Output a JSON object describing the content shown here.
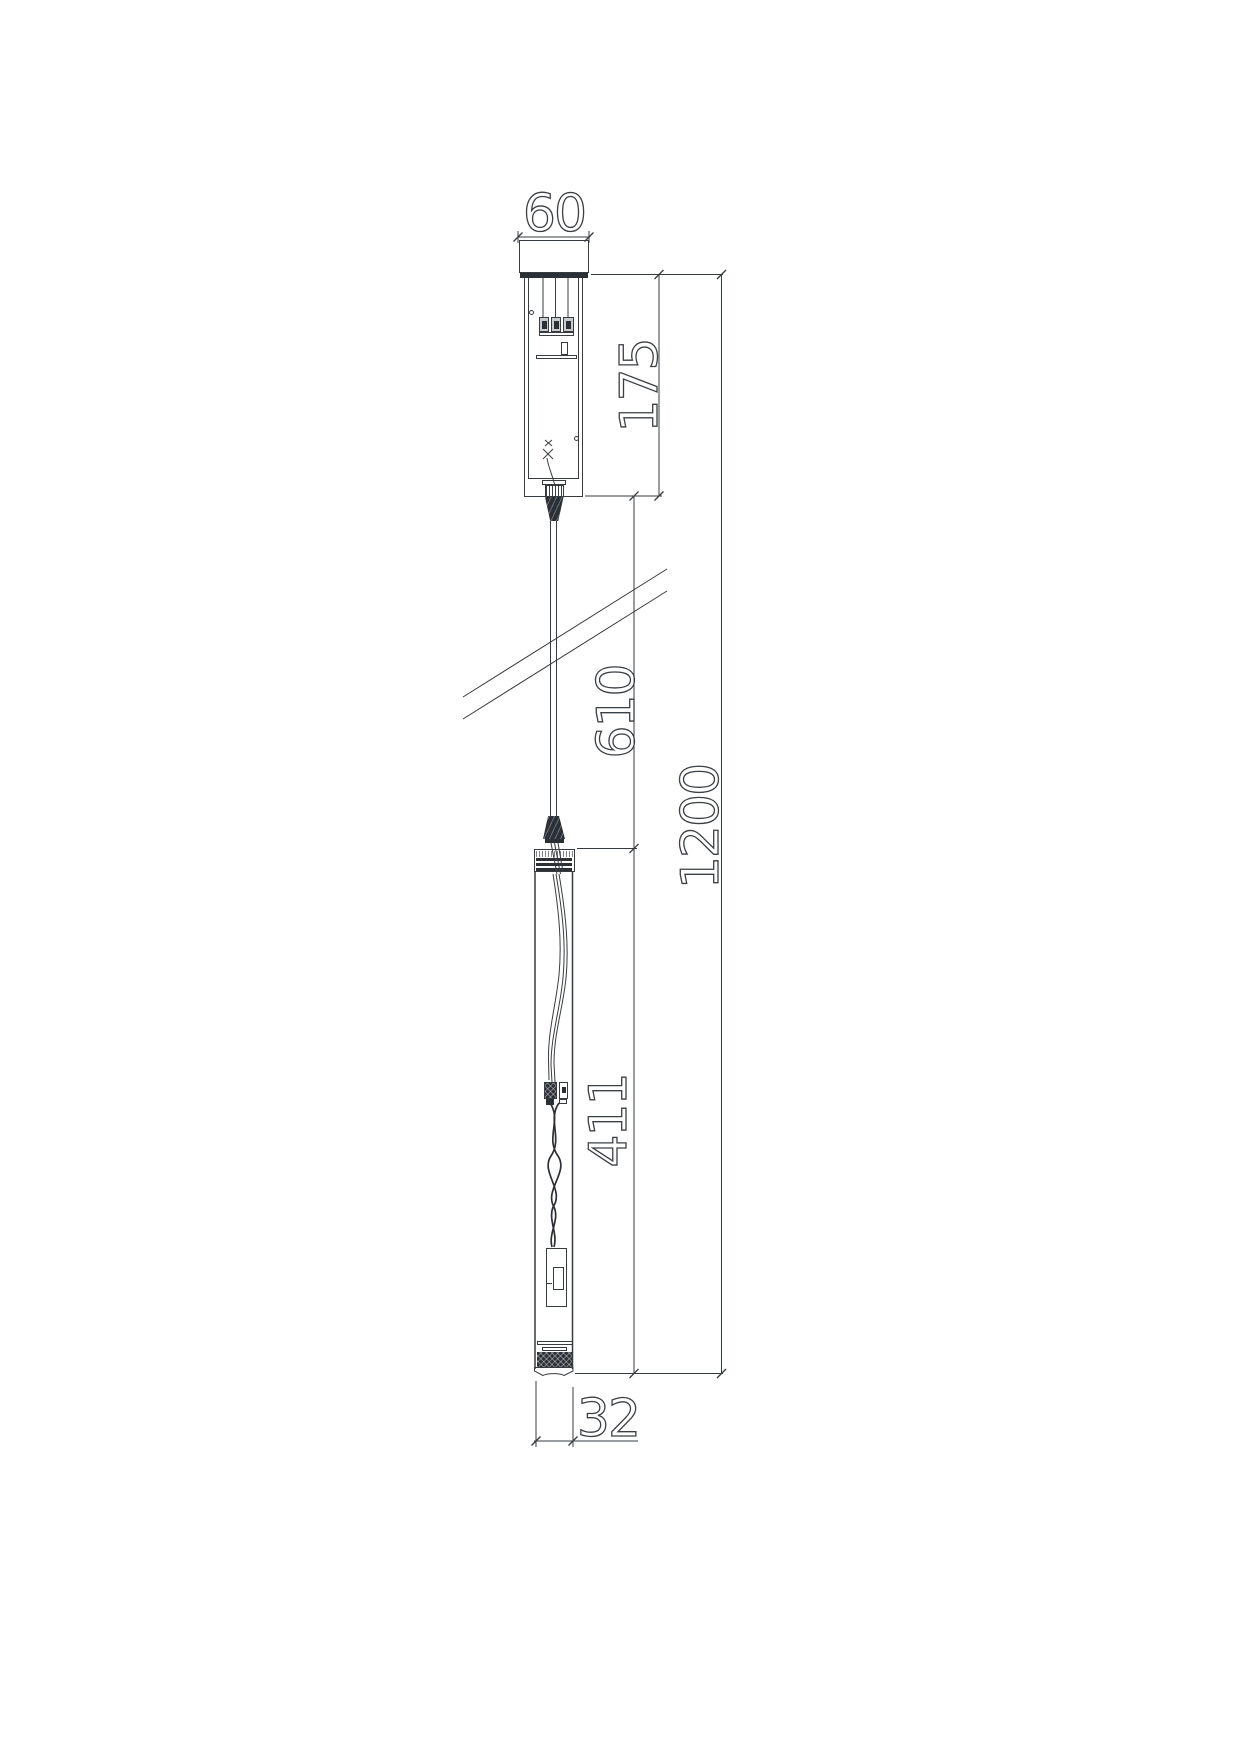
{
  "drawing": {
    "dimensions": {
      "canopy_width": "60",
      "canopy_height": "175",
      "cable_drop": "610",
      "tube_length": "411",
      "overall_drop": "1200",
      "tube_diameter": "32"
    },
    "colors": {
      "line": "#373c41",
      "dark_fill": "#2b3036",
      "background": "#ffffff"
    }
  }
}
